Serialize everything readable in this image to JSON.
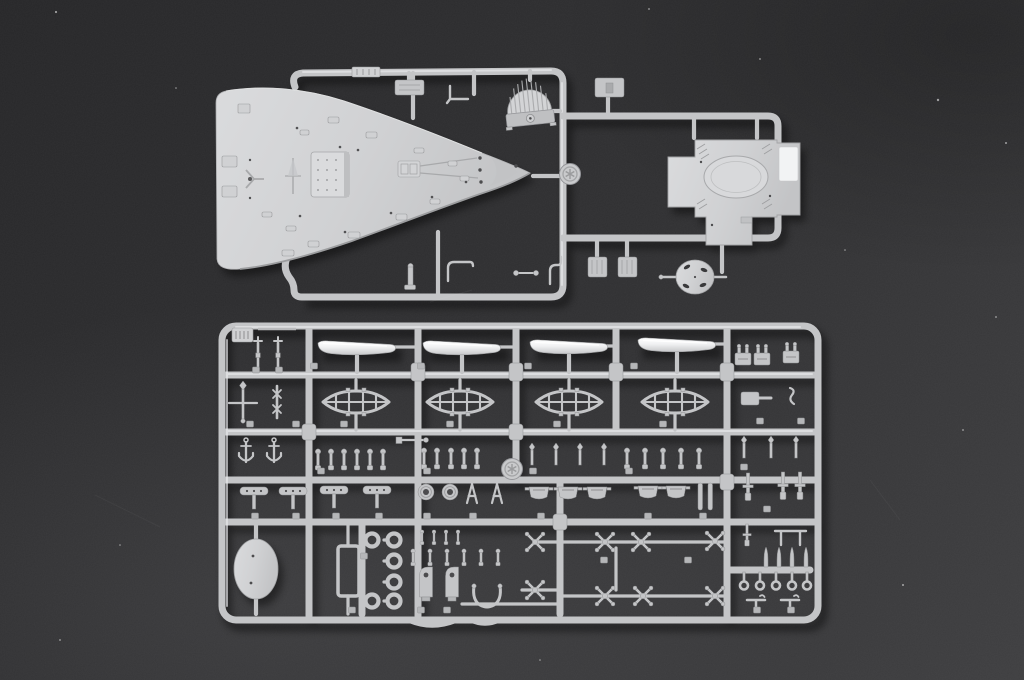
{
  "meta": {
    "type": "photograph",
    "subject": "Two light-grey injection-molded plastic sprues of a warship model kit photographed on a dark charcoal surface",
    "layout": "large deck sprue at top with cross-shaped superstructure piece at right; large rectangular fittings sprue below"
  },
  "scene": {
    "colors": {
      "bg_top": "#262628",
      "bg_mid": "#303032",
      "bg_bottom": "#3e3e40",
      "plastic": "#c4c5c7",
      "plastic_hi": "#e9eaec",
      "plastic_lo": "#97989a",
      "boat_white": "#f4f5f6",
      "shadow": "#000000"
    },
    "dust_speck_count": 13
  },
  "sprues": [
    {
      "id": "A",
      "name": "deck-and-superstructure-sprue",
      "position": "top",
      "parts": [
        {
          "name": "forecastle-deck",
          "count": 1,
          "desc": "long pointed main deck piece with molded barbette, windlass, anchor-chain runs and fittings"
        },
        {
          "name": "ribbed-dome-grating",
          "count": 1
        },
        {
          "name": "superstructure-deck",
          "count": 1,
          "desc": "cross-shaped deck with large oval barbette and glossy white panel"
        },
        {
          "name": "oval-platform",
          "count": 1
        },
        {
          "name": "equipment-box",
          "count": 3
        },
        {
          "name": "small-runner-fittings",
          "count": 7
        },
        {
          "name": "mold-stamp",
          "count": 1
        }
      ]
    },
    {
      "id": "B",
      "name": "fittings-sprue",
      "position": "bottom",
      "parts": [
        {
          "name": "ships-boat-hull",
          "count": 4,
          "color": "white"
        },
        {
          "name": "open-lattice-boat",
          "count": 4
        },
        {
          "name": "mast",
          "count": 2
        },
        {
          "name": "yardarm-mast",
          "count": 2
        },
        {
          "name": "anchor",
          "count": 2
        },
        {
          "name": "railing-stanchion",
          "count": 25
        },
        {
          "name": "boat-chock-platform",
          "count": 4
        },
        {
          "name": "life-ring",
          "count": 6
        },
        {
          "name": "winch-pot",
          "count": 5
        },
        {
          "name": "x-shaped-fitting",
          "count": 8
        },
        {
          "name": "gun-mount",
          "count": 7
        },
        {
          "name": "tapered-pin",
          "count": 4
        },
        {
          "name": "ringed-pin",
          "count": 5
        },
        {
          "name": "oval-blank-plate",
          "count": 1
        },
        {
          "name": "rectangular-frame",
          "count": 1
        },
        {
          "name": "wishbone-bracket",
          "count": 1
        },
        {
          "name": "curved-strip",
          "count": 2
        },
        {
          "name": "mold-stamp",
          "count": 1
        },
        {
          "name": "sprue-letter-tag",
          "count": 1
        }
      ]
    }
  ]
}
